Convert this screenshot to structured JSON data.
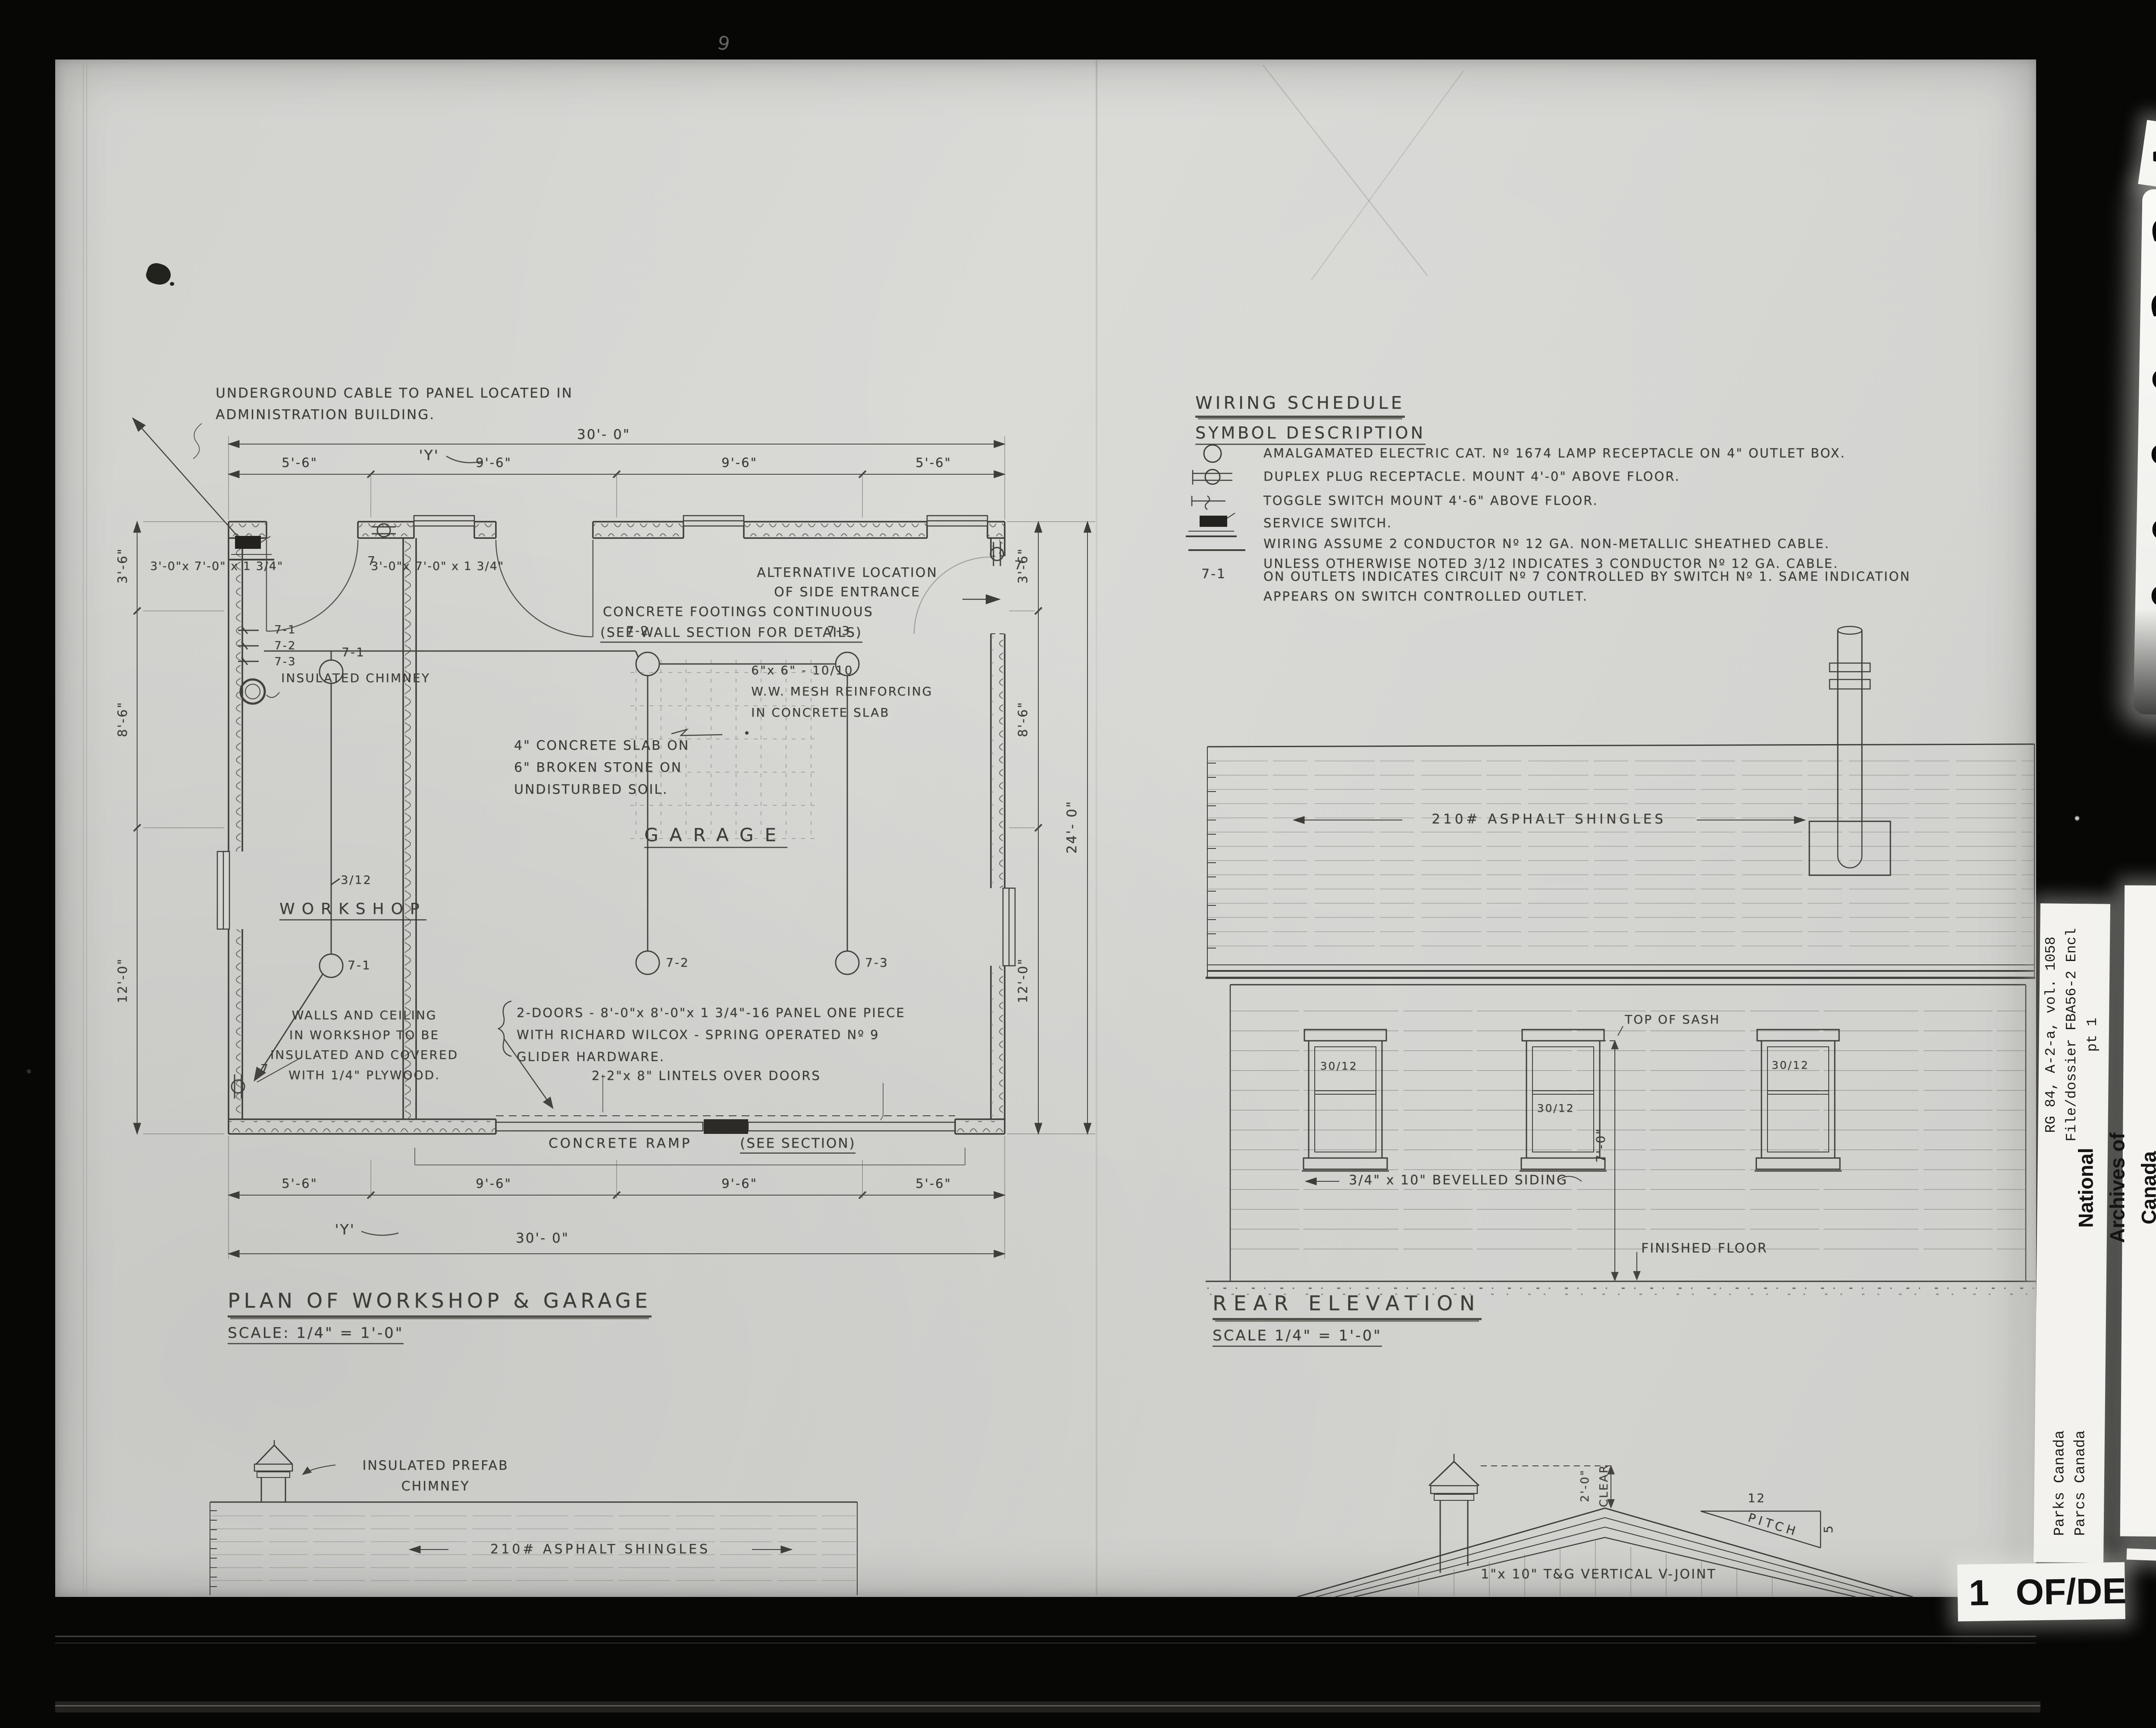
{
  "plan": {
    "title": "PLAN OF WORKSHOP & GARAGE",
    "scale": "SCALE: 1/4\" = 1'-0\"",
    "rooms": {
      "garage": "GARAGE",
      "workshop": "WORKSHOP"
    },
    "dims": {
      "overall_w": "30'- 0\"",
      "seg_a": "5'-6\"",
      "seg_b": "9'-6\"",
      "depth_a": "3'-6\"",
      "depth_b": "8'-6\"",
      "depth_c": "12'-0\"",
      "overall_d": "24'- 0\"",
      "y_ref": "'Y'"
    },
    "circuits": {
      "c1": "7-1",
      "c2": "7-2",
      "c3": "7-3",
      "plug": "7"
    },
    "notes": {
      "underground": "UNDERGROUND CABLE TO PANEL LOCATED IN\nADMINISTRATION BUILDING.",
      "alt_entrance": "ALTERNATIVE LOCATION\nOF SIDE ENTRANCE",
      "footings1": "CONCRETE FOOTINGS CONTINUOUS",
      "footings2": "(SEE WALL SECTION FOR DETAILS)",
      "mesh": "6\"x 6\" - 10/10\nW.W. MESH REINFORCING\nIN CONCRETE SLAB",
      "slab": "4\" CONCRETE SLAB ON\n6\" BROKEN STONE ON\nUNDISTURBED SOIL.",
      "walls": "WALLS AND CEILING\nIN WORKSHOP TO BE\nINSULATED AND COVERED\nWITH 1/4\" PLYWOOD.",
      "doors": "2-DOORS - 8'-0\"x 8'-0\"x 1 3/4\"-16 PANEL ONE PIECE\nWITH RICHARD WILCOX - SPRING OPERATED Nº 9\nGLIDER HARDWARE.",
      "lintels": "2-2\"x 8\" LINTELS OVER DOORS",
      "ramp": "CONCRETE RAMP",
      "ramp_see": "(SEE SECTION)",
      "chimney": "INSULATED CHIMNEY",
      "door_size": "3'-0\"x 7'-0\" x 1 3/4\"",
      "wire_code": "3/12"
    }
  },
  "schedule": {
    "title": "WIRING SCHEDULE",
    "subtitle": "SYMBOL DESCRIPTION",
    "lamp": "AMALGAMATED ELECTRIC CAT. Nº 1674 LAMP RECEPTACLE ON 4\" OUTLET BOX.",
    "duplex": "DUPLEX PLUG RECEPTACLE. MOUNT 4'-0\" ABOVE FLOOR.",
    "toggle": "TOGGLE SWITCH MOUNT 4'-6\" ABOVE FLOOR.",
    "service": "SERVICE SWITCH.",
    "wiring": "WIRING ASSUME 2 CONDUCTOR Nº 12 GA. NON-METALLIC SHEATHED CABLE.\nUNLESS OTHERWISE NOTED  3/12 INDICATES 3 CONDUCTOR Nº 12 GA. CABLE.",
    "circuit_code": "7-1",
    "circuit": "ON OUTLETS INDICATES CIRCUIT Nº 7 CONTROLLED BY SWITCH Nº 1. SAME INDICATION\nAPPEARS ON SWITCH CONTROLLED OUTLET."
  },
  "rear": {
    "title": "REAR ELEVATION",
    "scale": "SCALE 1/4\" = 1'-0\"",
    "shingles": "210# ASPHALT SHINGLES",
    "top_of_sash": "TOP OF SASH",
    "siding": "3/4\" x 10\" BEVELLED SIDING",
    "floor": "FINISHED FLOOR",
    "window": "30/12",
    "height": "7'-0\""
  },
  "side": {
    "chimney_note": "INSULATED PREFAB\nCHIMNEY"
  },
  "gable": {
    "vjoint": "1\"x 10\" T&G VERTICAL V-JOINT",
    "clear": "2'-0\"\nCLEAR",
    "rise": "12",
    "pitch": "PITCH",
    "run": "5"
  },
  "archive": {
    "digits": [
      "2",
      "2",
      "0",
      "0",
      "0",
      "0"
    ],
    "letter": "A",
    "rg": "RG 84, A-2-a, vol. 1058\nFile/dossier FBA56-2 Encl\npt 1",
    "parks": "Parks Canada\nParcs Canada",
    "national": "National Archives of Canada\nArchives nationales du Canada",
    "page_num": "1",
    "page_label": "OF/DE",
    "speck": "9"
  },
  "colors": {
    "paper": "#d5d5d2",
    "ink": "#3e3c36",
    "margin": "#070706",
    "label_white": "#f3f2ee"
  }
}
